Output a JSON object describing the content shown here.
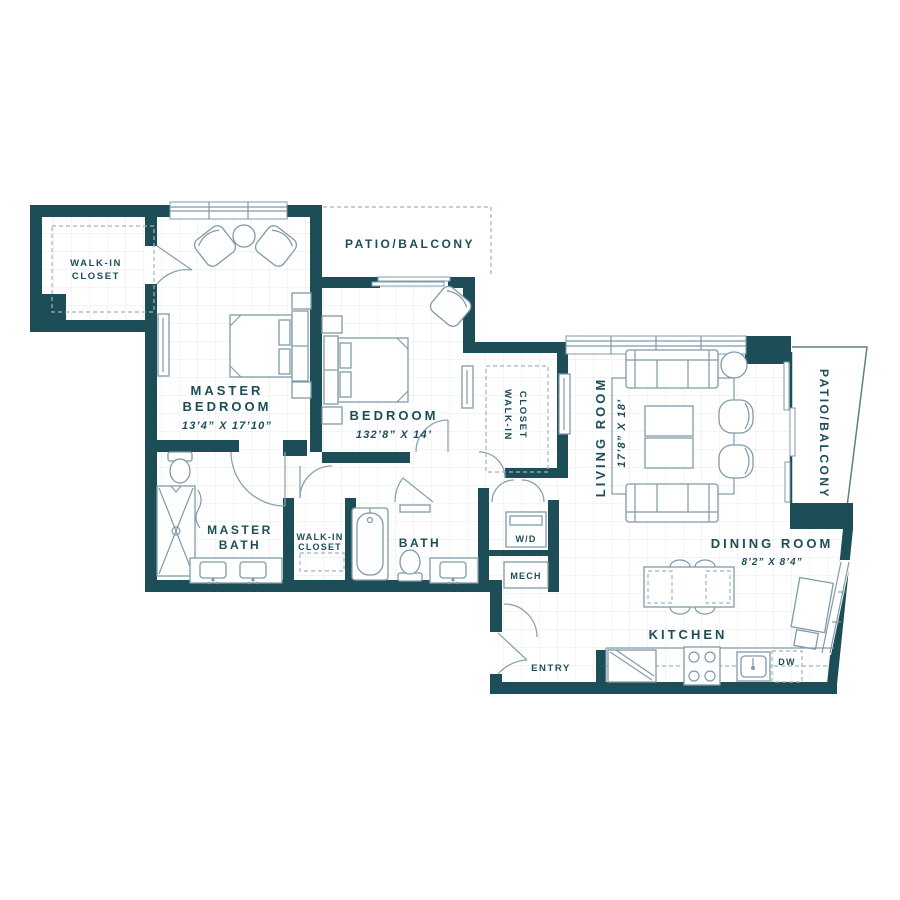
{
  "plan": {
    "colors": {
      "wall": "#1d4e57",
      "furniture_line": "#7f9aa8",
      "grid": "#e5eaed",
      "text": "#1d4e57"
    },
    "rooms": {
      "walk_in_closet_top": {
        "line1": "WALK-IN",
        "line2": "CLOSET"
      },
      "master_bedroom": {
        "line1": "MASTER",
        "line2": "BEDROOM",
        "dims": "13’4” X 17’10”"
      },
      "patio_top": {
        "label": "PATIO/BALCONY"
      },
      "bedroom": {
        "label": "BEDROOM",
        "dims": "132’8” X 14’"
      },
      "walk_in_closet_mid": {
        "line1": "WALK-IN",
        "line2": "CLOSET"
      },
      "living_room": {
        "label": "LIVING ROOM",
        "dims": "17’8” X 18’"
      },
      "patio_right": {
        "label": "PATIO/BALCONY"
      },
      "dining_room": {
        "label": "DINING ROOM",
        "dims": "8’2” X 8’4”"
      },
      "kitchen": {
        "label": "KITCHEN"
      },
      "master_bath": {
        "line1": "MASTER",
        "line2": "BATH"
      },
      "walk_in_closet_small": {
        "line1": "WALK-IN",
        "line2": "CLOSET"
      },
      "bath": {
        "label": "BATH"
      },
      "washer_dryer": {
        "label": "W/D"
      },
      "mechanical": {
        "label": "MECH"
      },
      "entry": {
        "label": "ENTRY"
      },
      "dishwasher": {
        "label": "DW"
      }
    }
  }
}
